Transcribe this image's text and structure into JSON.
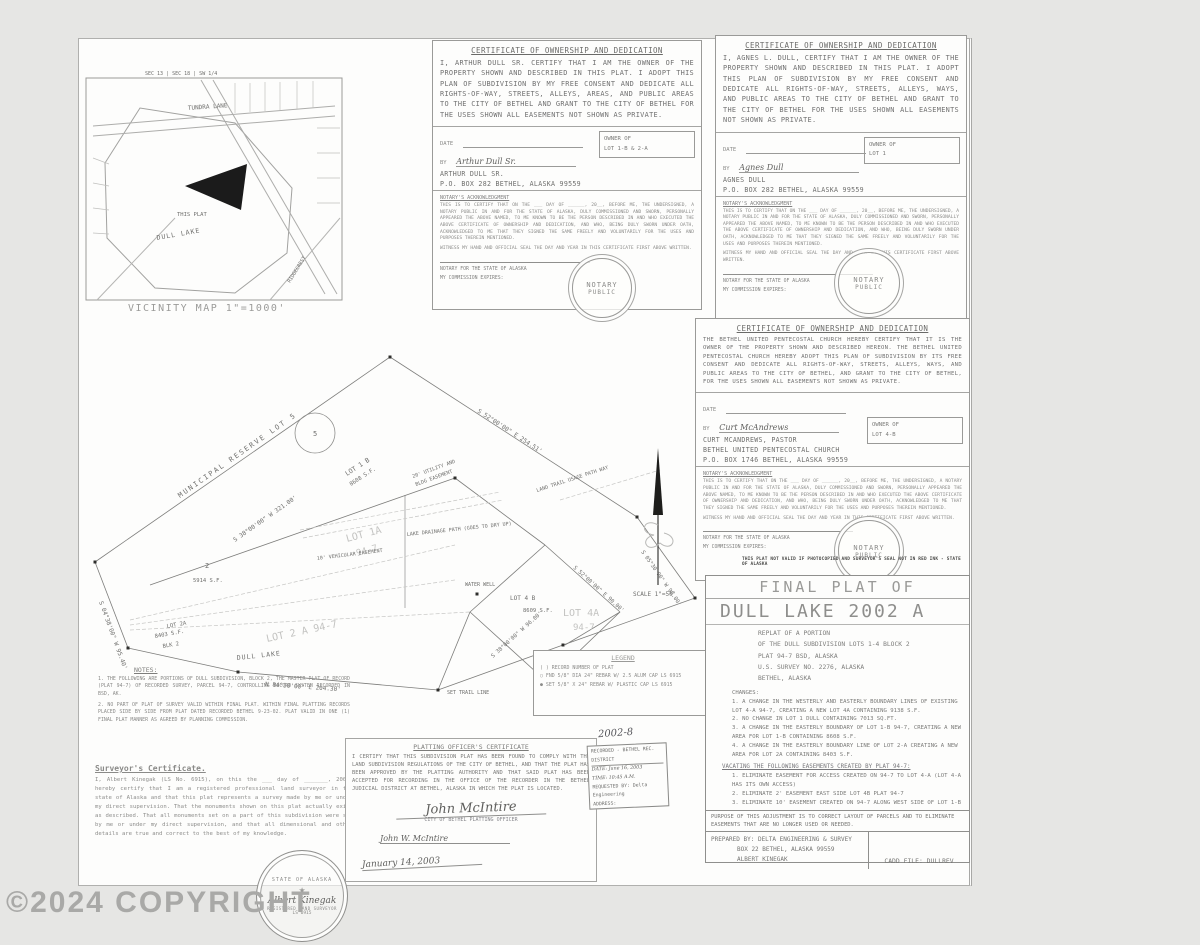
{
  "watermark": "©2024 COPYRIGHT",
  "vicinity": {
    "caption": "VICINITY MAP  1\"=1000'",
    "sec_note": "SEC 13 | SEC 18 | SW 1/4",
    "road_top": "TUNDRA LANE",
    "lake": "DULL LAKE",
    "this_plat": "THIS PLAT",
    "road_br": "RIDGECREST"
  },
  "certs": {
    "owner1": {
      "title": "CERTIFICATE OF OWNERSHIP AND DEDICATION",
      "body": "I, ARTHUR DULL SR. CERTIFY THAT I AM THE OWNER OF THE PROPERTY SHOWN AND DESCRIBED IN THIS PLAT. I ADOPT THIS PLAN OF SUBDIVISION BY MY FREE CONSENT AND DEDICATE ALL RIGHTS-OF-WAY, STREETS, ALLEYS, AREAS, AND PUBLIC AREAS TO THE CITY OF BETHEL AND GRANT TO THE CITY OF BETHEL FOR THE USES SHOWN ALL EASEMENTS NOT SHOWN AS PRIVATE.",
      "date_label": "DATE",
      "by_label": "BY",
      "signature": "Arthur Dull Sr.",
      "name": "ARTHUR DULL SR.",
      "address": "P.O. BOX 282 BETHEL, ALASKA 99559",
      "owner_of": "OWNER OF",
      "owner_lots": "LOT 1-B & 2-A"
    },
    "owner2": {
      "title": "CERTIFICATE OF OWNERSHIP AND DEDICATION",
      "body": "I, AGNES L. DULL, CERTIFY THAT I AM THE OWNER OF THE PROPERTY SHOWN AND DESCRIBED IN THIS PLAT. I ADOPT THIS PLAN OF SUBDIVISION BY MY FREE CONSENT AND DEDICATE ALL RIGHTS-OF-WAY, STREETS, ALLEYS, WAYS, AND PUBLIC AREAS TO THE CITY OF BETHEL AND GRANT TO THE CITY OF BETHEL FOR THE USES SHOWN ALL EASEMENTS NOT SHOWN AS PRIVATE.",
      "date_label": "DATE",
      "by_label": "BY",
      "signature": "Agnes Dull",
      "name": "AGNES DULL",
      "address": "P.O. BOX 282 BETHEL, ALASKA 99559",
      "owner_of": "OWNER OF",
      "owner_lots": "LOT 1"
    },
    "church": {
      "title": "CERTIFICATE OF OWNERSHIP AND DEDICATION",
      "body": "THE BETHEL UNITED PENTECOSTAL CHURCH HEREBY CERTIFY THAT IT IS THE OWNER OF THE PROPERTY SHOWN AND DESCRIBED HEREON.  THE BETHEL UNITED PENTECOSTAL CHURCH HEREBY ADOPT THIS PLAN OF SUBDIVISION BY ITS FREE CONSENT AND DEDICATE ALL RIGHTS-OF-WAY, STREETS, ALLEYS, WAYS, AND PUBLIC AREAS TO THE CITY OF BETHEL, AND GRANT TO THE CITY OF BETHEL, FOR THE USES SHOWN ALL EASEMENTS NOT SHOWN AS PRIVATE.",
      "date_label": "DATE",
      "by_label": "BY",
      "signature": "Curt McAndrews",
      "name": "CURT MCANDREWS, PASTOR",
      "name2": "BETHEL UNITED PENTECOSTAL CHURCH",
      "address": "P.O. BOX 1746 BETHEL, ALASKA 99559",
      "owner_of": "OWNER OF",
      "owner_lots": "LOT 4-B"
    },
    "notary": {
      "heading": "NOTARY'S ACKNOWLEDGMENT",
      "body": "THIS IS TO CERTIFY THAT ON THE ___ DAY OF ______, 20__, BEFORE ME, THE UNDERSIGNED, A NOTARY PUBLIC IN AND FOR THE STATE OF ALASKA, DULY COMMISSIONED AND SWORN, PERSONALLY APPEARED THE ABOVE NAMED, TO ME KNOWN TO BE THE PERSON DESCRIBED IN AND WHO EXECUTED THE ABOVE CERTIFICATE OF OWNERSHIP AND DEDICATION, AND WHO, BEING DULY SWORN UNDER OATH, ACKNOWLEDGED TO ME THAT THEY SIGNED THE SAME FREELY AND VOLUNTARILY FOR THE USES AND PURPOSES THEREIN MENTIONED.",
      "witness": "WITNESS MY HAND AND OFFICIAL SEAL THE DAY AND YEAR IN THIS CERTIFICATE FIRST ABOVE WRITTEN.",
      "notary_line": "NOTARY FOR THE STATE OF ALASKA",
      "commission": "MY COMMISSION EXPIRES:",
      "seal1": "NOTARY",
      "seal2": "PUBLIC"
    }
  },
  "title_block": {
    "final": "FINAL PLAT OF",
    "title": "DULL LAKE 2002 A",
    "sub0": "REPLAT OF A PORTION",
    "sub1": "OF THE DULL SUBDIVISION LOTS 1-4 BLOCK 2",
    "sub2": "PLAT 94-7 BSD, ALASKA",
    "sub3": "U.S. SURVEY NO. 2276, ALASKA",
    "sub4": "BETHEL, ALASKA",
    "changes_heading": "CHANGES:",
    "changes0": "1. A CHANGE IN THE WESTERLY AND EASTERLY BOUNDARY LINES OF EXISTING LOT 4-A 94-7, CREATING A NEW LOT 4A CONTAINING 9138 S.F.",
    "changes1": "2. NO CHANGE IN LOT 1 DULL CONTAINING 7013 SQ.FT.",
    "changes2": "3. A CHANGE IN THE EASTERLY BOUNDARY OF LOT 1-B 94-7, CREATING A NEW AREA FOR LOT 1-B CONTAINING 8608 S.F.",
    "changes3": "4. A CHANGE IN THE EASTERLY BOUNDARY LINE OF LOT 2-A CREATING A NEW AREA FOR LOT 2A CONTAINING 8403 S.F.",
    "vacating_heading": "VACATING THE FOLLOWING EASEMENTS CREATED BY PLAT 94-7:",
    "vacating0": "1. ELIMINATE EASEMENT FOR ACCESS CREATED ON 94-7 TO LOT 4-A (LOT 4-A HAS ITS OWN ACCESS)",
    "vacating1": "2. ELIMINATE 2' EASEMENT EAST SIDE LOT 4B PLAT 94-7",
    "vacating2": "3. ELIMINATE 10' EASEMENT CREATED ON 94-7 ALONG WEST SIDE OF LOT 1-B",
    "purpose": "PURPOSE OF THIS ADJUSTMENT IS TO CORRECT LAYOUT OF PARCELS AND TO ELIMINATE EASEMENTS THAT ARE NO LONGER USED OR NEEDED.",
    "prep0": "PREPARED BY: DELTA ENGINEERING & SURVEY",
    "prep1": "BOX 22  BETHEL, ALASKA 99559",
    "prep2": "ALBERT KINEGAK",
    "cadd": "CADD FILE: DULLREV",
    "not_valid": "THIS PLAT NOT VALID IF PHOTOCOPIED AND SURVEYOR'S SEAL NOT IN RED INK - STATE OF ALASKA"
  },
  "notes": {
    "heading": "NOTES:",
    "item1": "1. THE FOLLOWING ARE PORTIONS OF DULL SUBDIVISION, BLOCK 2, THE MASTER PLAT OF RECORD (PLAT 94-7) OF RECORDED SURVEY, PARCEL 94-7, CONTROLLING RECORD SYSTEM RECORDED IN BSD, AK.",
    "item2": "2. NO PART OF PLAT OF SURVEY VALID WITHIN FINAL PLAT. WITHIN FINAL PLATTING RECORDS PLACED SIDE BY SIDE FROM PLAT DATED RECORDED BETHEL 9-23-02. PLAT VALID IN ONE (1) FINAL PLAT MANNER AS AGREED BY PLANNING COMMISSION."
  },
  "surveyor_cert": {
    "heading": "Surveyor's Certificate.",
    "body": "I, Albert Kinegak (LS No. 6915), on this the ___ day of _______, 2002, hereby certify that I am a registered professional land surveyor in the state of Alaska and that this plat represents a survey made by me or under my direct supervision. That the monuments shown on this plat actually exist as described. That all monuments set on a part of this subdivision were set by me or under my direct supervision, and that all dimensional and other details are true and correct to the best of my knowledge."
  },
  "platting_cert": {
    "heading": "PLATTING OFFICER'S CERTIFICATE",
    "body": "I CERTIFY THAT THIS SUBDIVISION PLAT HAS BEEN FOUND TO COMPLY WITH THE LAND SUBDIVISION REGULATIONS OF THE CITY OF BETHEL,  AND THAT THE PLAT HAS BEEN APPROVED BY THE PLATTING AUTHORITY AND THAT SAID PLAT HAS BEEN ACCEPTED FOR RECORDING IN THE OFFICE OF THE RECORDER IN THE BETHEL JUDICIAL DISTRICT AT BETHEL, ALASKA IN WHICH THE PLAT IS LOCATED.",
    "signature": "John McIntire",
    "sig_label": "CITY OF BETHEL PLATTING OFFICER",
    "printed": "John W. McIntire",
    "date": "January 14, 2003"
  },
  "recording": {
    "number": "2002-8",
    "line1": "RECORDED - BETHEL REC. DISTRICT",
    "date": "DATE: June 16, 2003",
    "time": "TIME: 10:45 A.M.",
    "req": "REQUESTED BY: Delta Engineering",
    "addr": "ADDRESS:"
  },
  "legend": {
    "heading": "LEGEND",
    "item0": "( ) RECORD NUMBER OF PLAT",
    "item1": "○ FND 5/8\" DIA 24\" REBAR W/ 2.5 ALUM CAP LS 6915",
    "item2": "● SET 5/8\" X 24\" REBAR W/ PLASTIC CAP LS 6915"
  },
  "seal": {
    "top": "STATE OF ALASKA",
    "star": "★",
    "name": "Albert Kinegak",
    "bottom": "REGISTERED LAND SURVEYOR",
    "no": "LS 6915"
  },
  "drawing": {
    "muni": "MUNICIPAL RESERVE        LOT 5",
    "circle5": "5",
    "lot1b": "LOT 1 B",
    "lot1b_area": "8608 S.F.",
    "util1": "20' UTILITY AND",
    "util2": "BLDG EASEMENT",
    "ghost_lot1a": "LOT 1A",
    "ghost_lot1a2": "94-7",
    "drainage": "LAKE DRAINAGE PATH (GOES TO DRY UP)",
    "trail": "LAND TRAIL USAGE PATH WAY",
    "vehic": "10' VEHICULAR EASEMENT",
    "well": "WATER WELL",
    "lot4b": "LOT 4 B",
    "lot4b_area": "8609 S.F.",
    "ghost_lot4a": "LOT 4A",
    "ghost_lot4a2": "94-7",
    "ghost_lot2a": "LOT 2 A  94-7",
    "lot2a": "LOT 2A",
    "lot2a_area": "8403 S.F.",
    "lot2a_blk": "BLK 2",
    "lot2": "2",
    "lot2_area": "5914 S.F.",
    "dull_lake": "DULL LAKE",
    "set_trail": "SET TRAIL LINE",
    "scale": "SCALE 1\"=50'",
    "b1": "S 38°00'00\" W  321.00'",
    "b2": "S 52°00'00\" E  254.51'",
    "b3": "S 04°38'00\" W  95.40'",
    "b4": "N 84°30'00\" E  204.30'",
    "b5": "S 52°00'00\" E  90.00'",
    "b6": "S 38°00'00\" W  96.00'",
    "b7": "S 05°30'00\" W  98.00'"
  }
}
